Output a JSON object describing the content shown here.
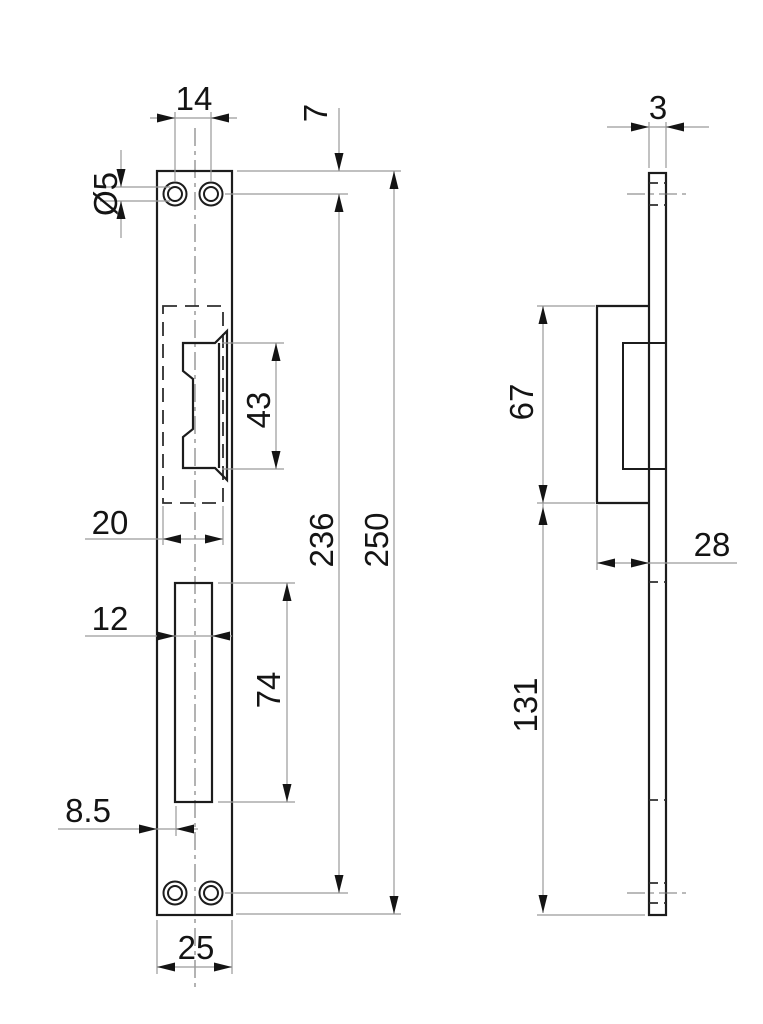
{
  "drawing": {
    "background": "#ffffff",
    "outline_color": "#1c1c1c",
    "dim_line_color": "#9a9a9a",
    "front_view": {
      "dimensions": {
        "hole_spacing": "14",
        "top_edge_to_hole": "7",
        "hole_diameter": "Ø5",
        "keeper_height": "43",
        "cutout_width": "20",
        "slot_width": "12",
        "hole_centers_span": "236",
        "plate_length": "250",
        "slot_height": "74",
        "slot_offset": "8.5",
        "plate_width": "25"
      }
    },
    "side_view": {
      "dimensions": {
        "plate_thickness": "3",
        "body_height": "67",
        "body_depth": "28",
        "body_to_bottom": "131"
      }
    }
  }
}
